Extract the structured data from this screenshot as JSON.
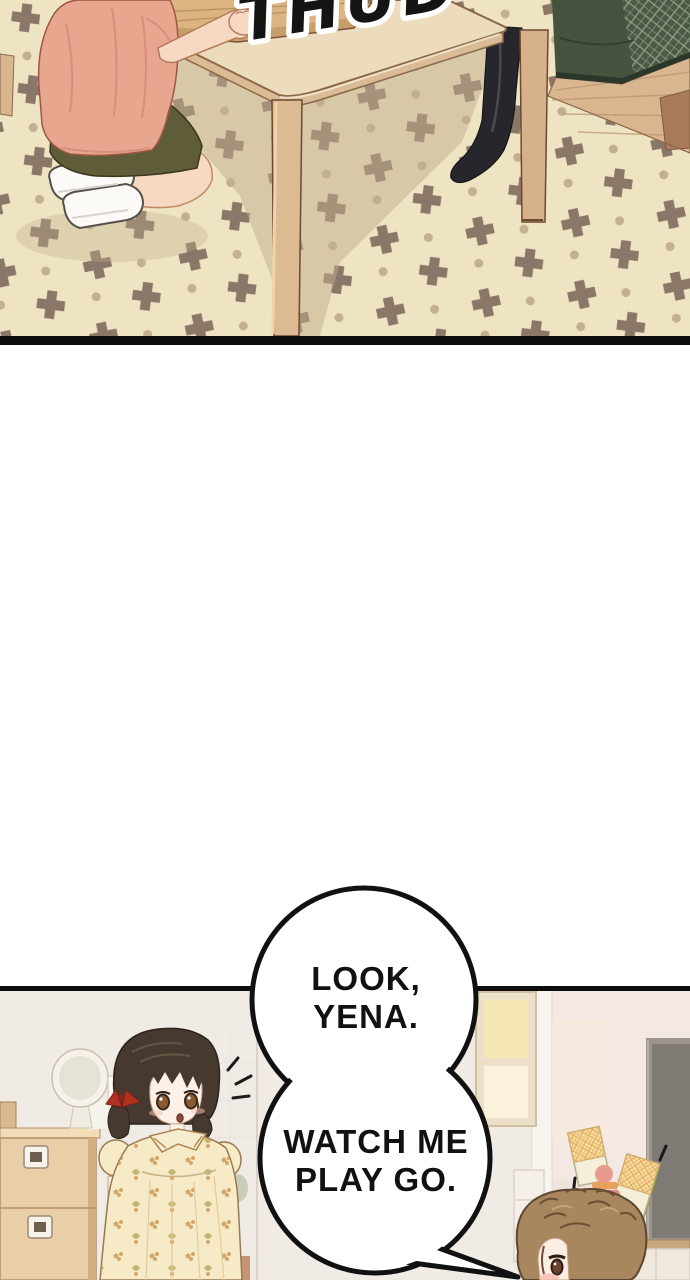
{
  "panel1": {
    "sfx_text": "THUD"
  },
  "speech_bubble": {
    "top_lines": [
      "LOOK,",
      "YENA."
    ],
    "bottom_lines": [
      "WATCH ME",
      "PLAY GO."
    ]
  },
  "palette": {
    "carpet_base": "#eee3c2",
    "carpet_motif": "#8b7768",
    "carpet_dot": "#c3b093",
    "carpet_shadow": "#bfae8e",
    "wood_floor": "#d9b690",
    "couch_green": "#45523e",
    "table_wood": "#ecdcbd",
    "table_edge": "#d9bc96",
    "leg_wood": "#dcba92",
    "board_wood": "#dcb482",
    "shirt_salmon": "#e8a68f",
    "shorts_olive": "#5f5c3a",
    "skin": "#f7d9c3",
    "black_sock": "#26262c",
    "wall": "#f1ebe6",
    "wall_pink": "#f3e8e2",
    "dresser_wood": "#e9cfa8",
    "girl_hair": "#463a30",
    "dress_cream": "#f6ebc6",
    "ribbon_red": "#b23222",
    "boy_hair": "#a8865e",
    "card_cream": "#f5eed8",
    "card_waffle": "#f6dfa2",
    "card_green": "#a9c262",
    "tv_grey": "#7f7a73",
    "ink": "#111111",
    "bubble_fill": "#ffffff"
  }
}
